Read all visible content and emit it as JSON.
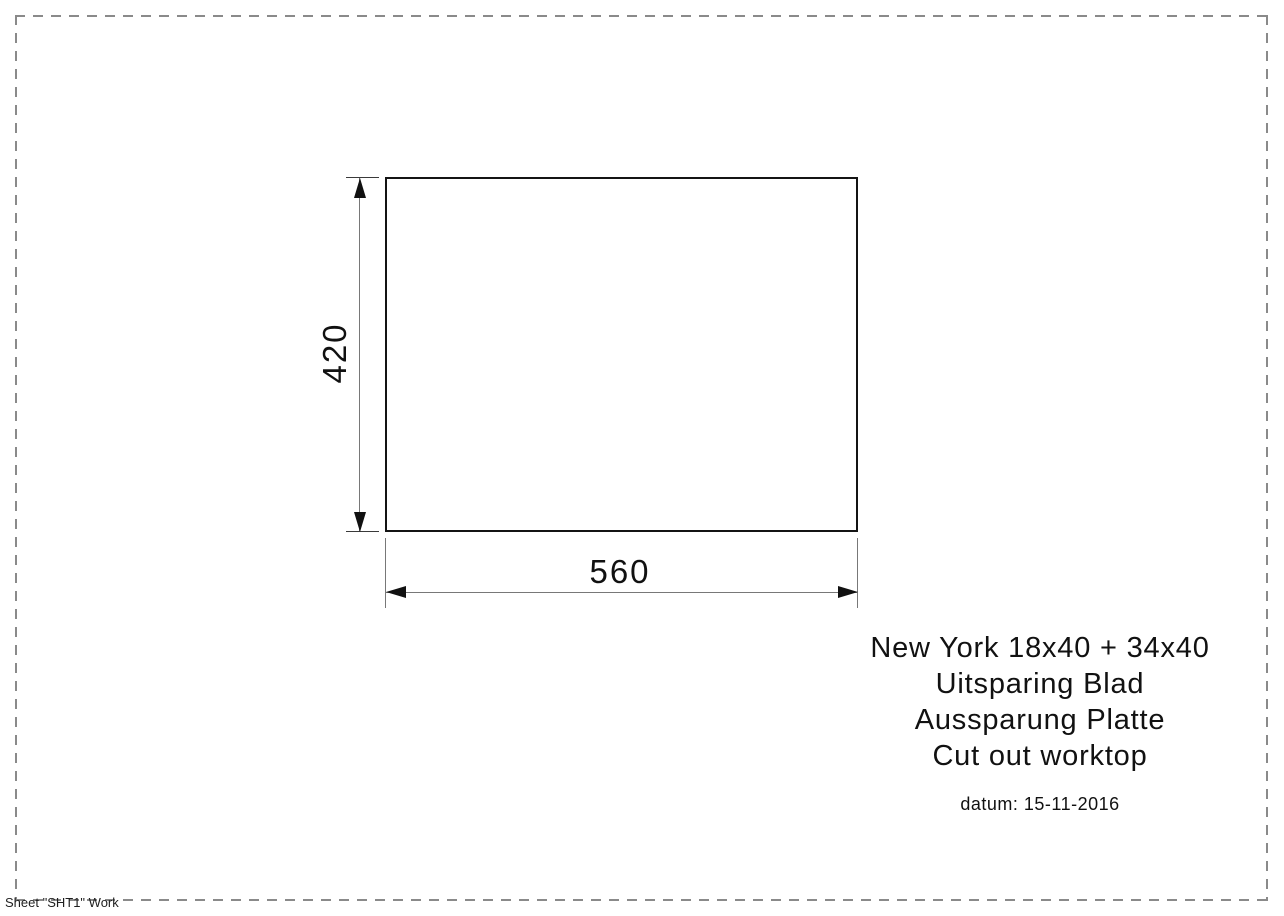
{
  "colors": {
    "drawing_line": "#141414",
    "dimension_line": "#787878",
    "border_dash": "#8a8a8a",
    "text": "#111111"
  },
  "drawing": {
    "height_dim_label": "420",
    "width_dim_label": "560"
  },
  "annotation": {
    "lines": [
      "New York 18x40 + 34x40",
      "Uitsparing Blad",
      "Aussparung Platte",
      "Cut out worktop"
    ],
    "datum": "datum: 15-11-2016"
  },
  "footer": {
    "sheet_label": "Sheet \"SHT1\" Work"
  }
}
